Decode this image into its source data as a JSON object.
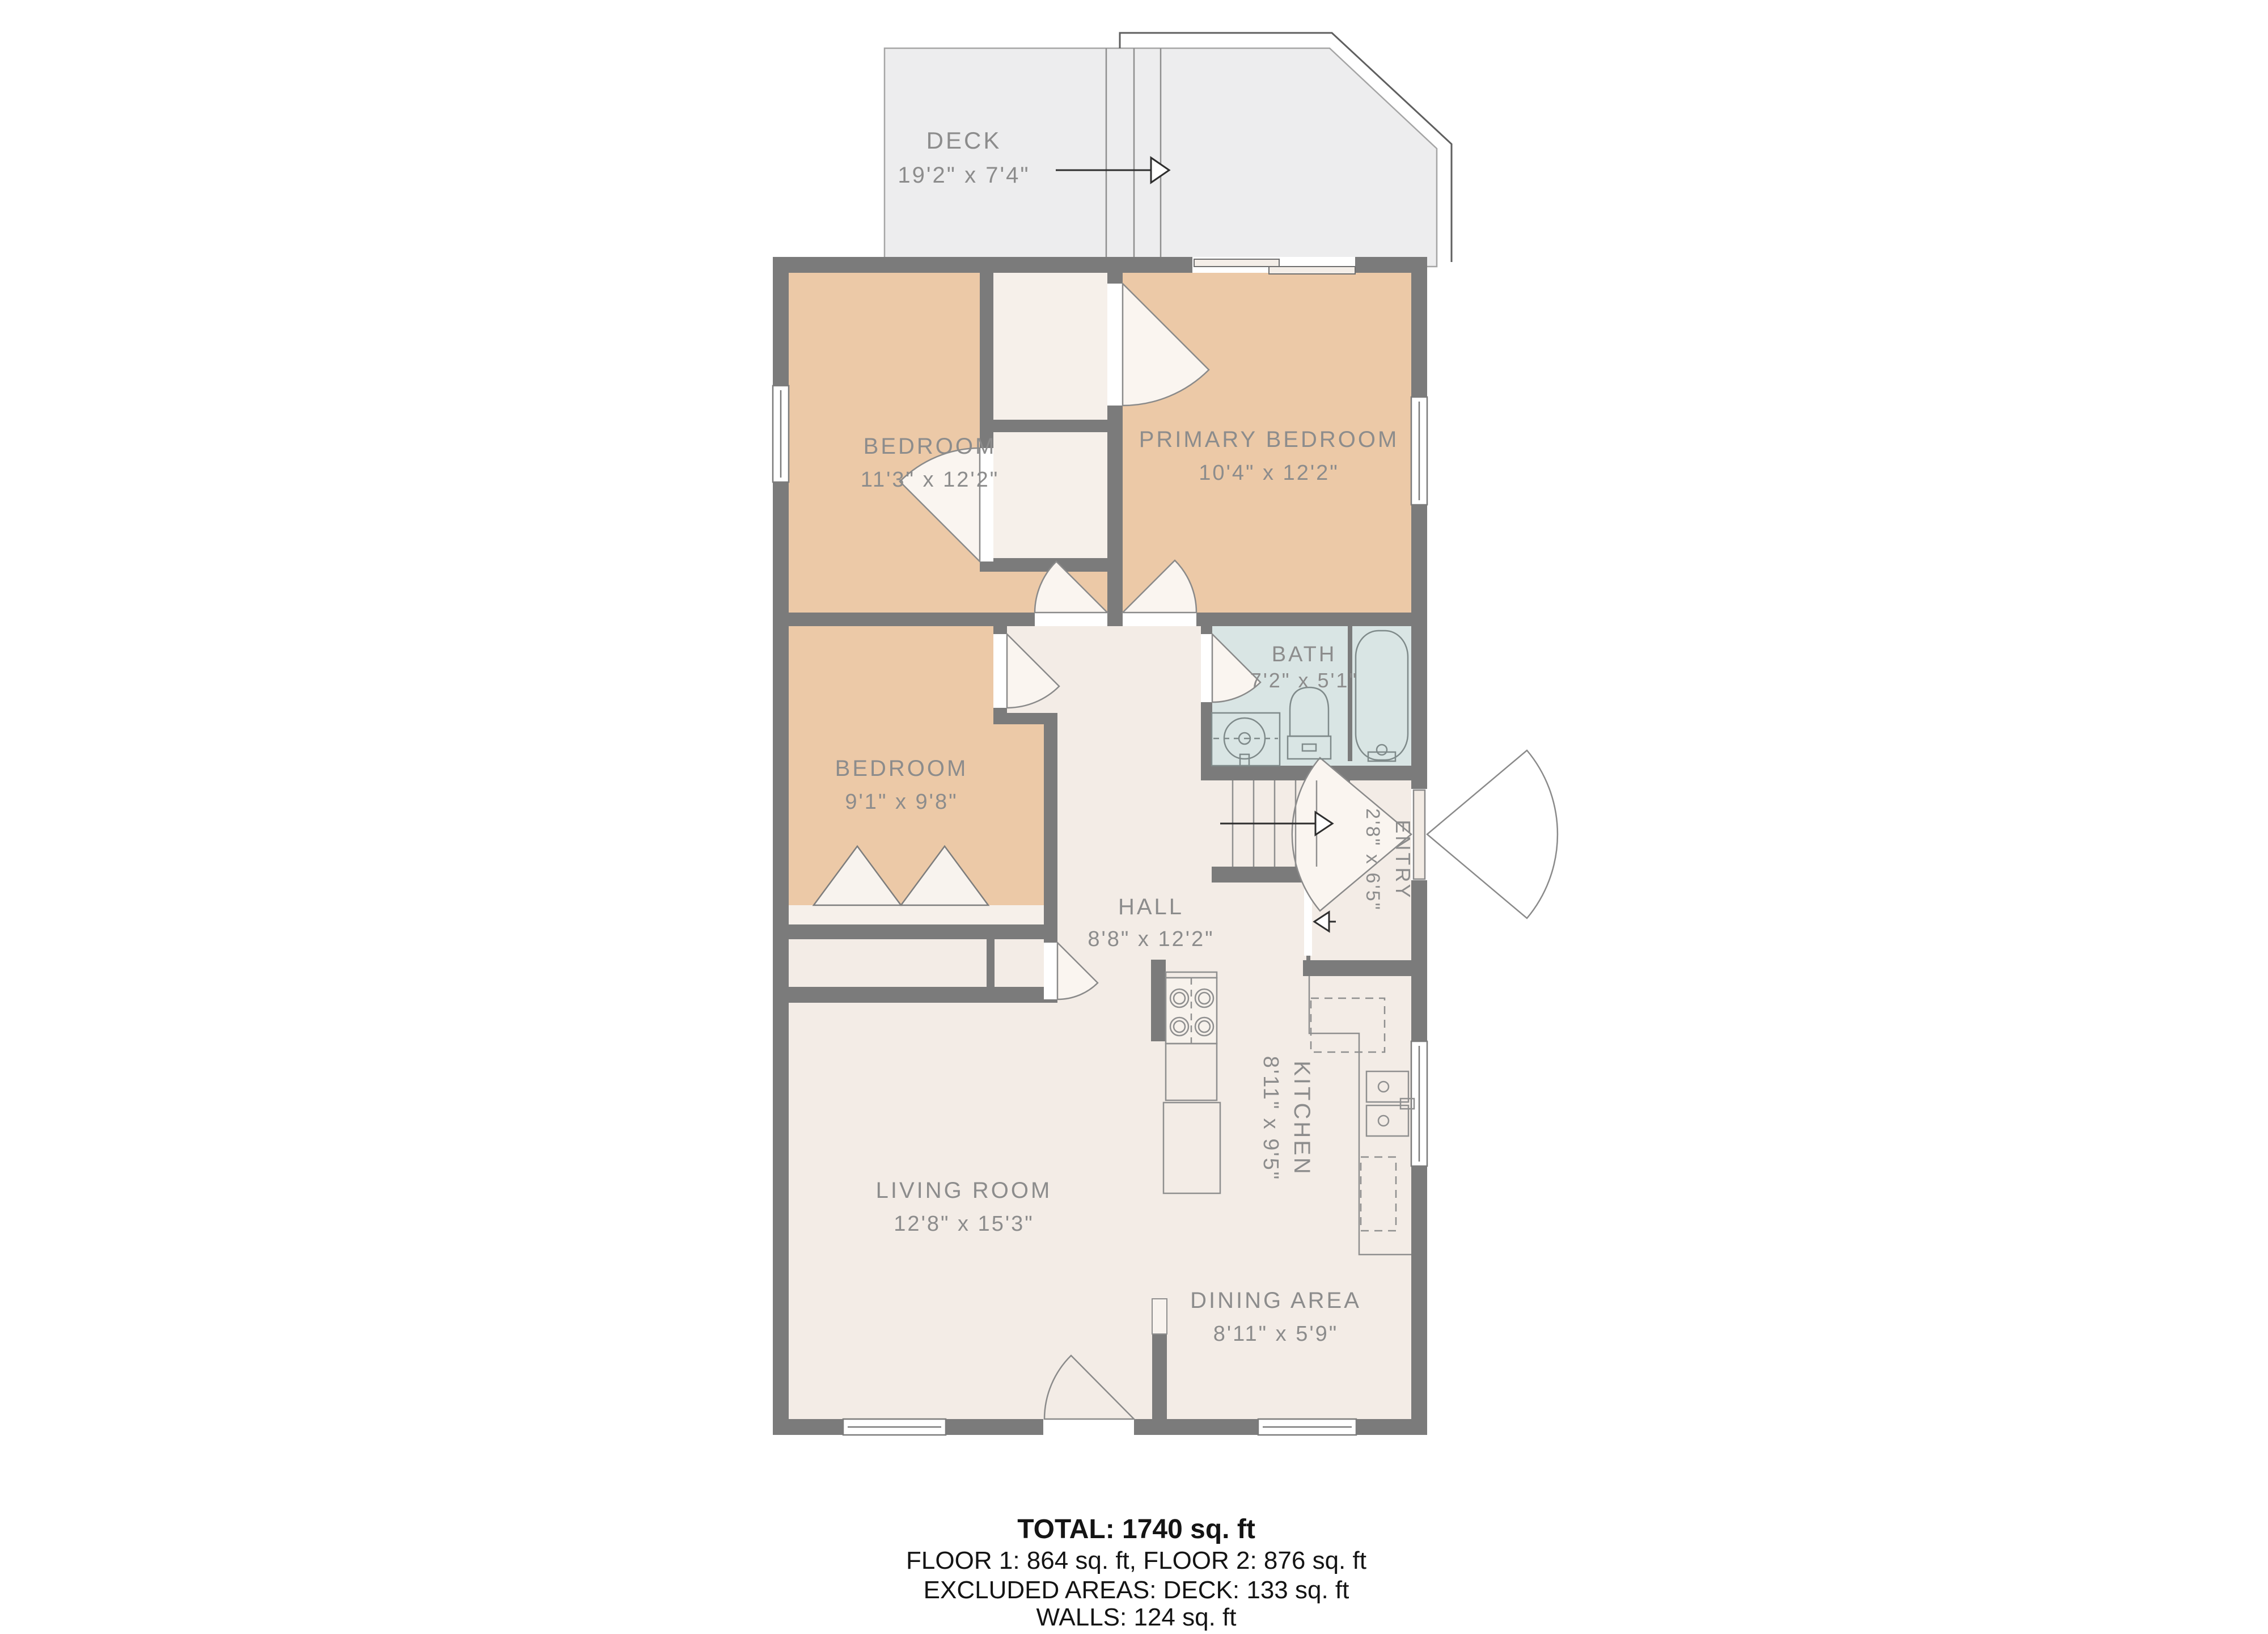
{
  "plan": {
    "deck": {
      "name": "DECK",
      "dims": "19'2\" x 7'4\""
    },
    "bedroom1": {
      "name": "BEDROOM",
      "dims": "11'3\" x 12'2\""
    },
    "primary": {
      "name": "PRIMARY BEDROOM",
      "dims": "10'4\" x 12'2\""
    },
    "bath": {
      "name": "BATH",
      "dims": "7'2\" x 5'1\""
    },
    "bedroom2": {
      "name": "BEDROOM",
      "dims": "9'1\" x 9'8\""
    },
    "entry": {
      "name": "ENTRY",
      "dims": "2'8\" x 6'5\""
    },
    "hall": {
      "name": "HALL",
      "dims": "8'8\" x 12'2\""
    },
    "kitchen": {
      "name": "KITCHEN",
      "dims": "8'11\" x 9'5\""
    },
    "living": {
      "name": "LIVING ROOM",
      "dims": "12'8\" x 15'3\""
    },
    "dining": {
      "name": "DINING AREA",
      "dims": "8'11\" x 5'9\""
    }
  },
  "summary": {
    "total": "TOTAL: 1740 sq. ft",
    "floors": "FLOOR 1: 864 sq. ft, FLOOR 2: 876 sq. ft",
    "excluded": "EXCLUDED AREAS: DECK: 133 sq. ft",
    "walls": "WALLS: 124 sq. ft"
  },
  "colors": {
    "wall": "#7b7b7b",
    "room_tan": "#ecc9a7",
    "floor_cream": "#f3ece6",
    "bath_blue": "#d9e5e4",
    "deck_gray": "#ededee",
    "label_gray": "#8c8c8c"
  }
}
